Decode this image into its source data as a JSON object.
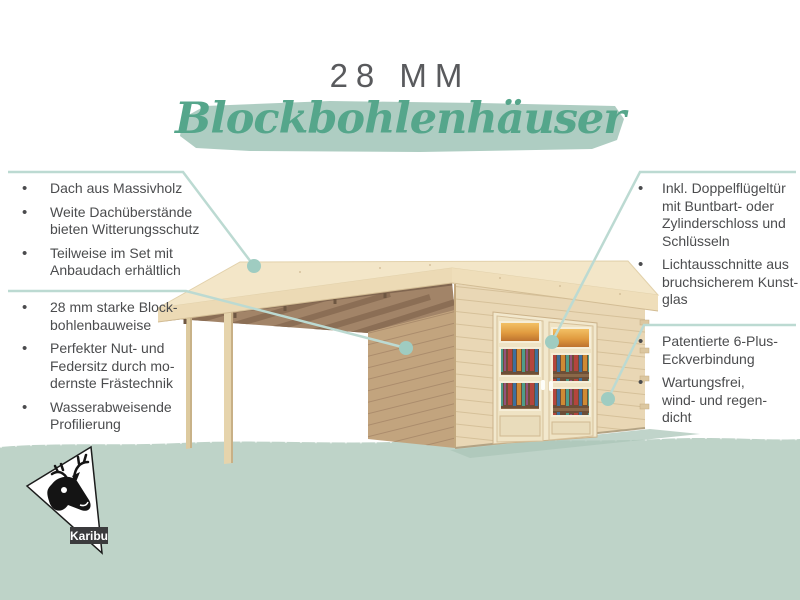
{
  "title": {
    "size": "28 MM",
    "script": "Blockbohlenhäuser"
  },
  "bullet_glyph": "•",
  "features": {
    "left_top": {
      "items": [
        "Dach aus Massivholz",
        "Weite Dachüberstände\nbieten Witterungsschutz",
        "Teilweise im Set mit\nAnbaudach erhältlich"
      ]
    },
    "left_bottom": {
      "items": [
        "28 mm starke Block-\nbohlenbauweise",
        "Perfekter Nut- und\nFedersitz durch mo-\ndernste Frästechnik",
        "Wasserabweisende\nProfilierung"
      ]
    },
    "right_top": {
      "items": [
        "Inkl. Doppelflügeltür\nmit Buntbart- oder\nZylinderschloss und\nSchlüsseln",
        "Lichtausschnitte aus\nbruchsicherem Kunst-\nglas"
      ]
    },
    "right_bottom": {
      "items": [
        "Patentierte 6-Plus-\nEckverbindung",
        "Wartungsfrei,\nwind- und regen-\ndicht"
      ]
    }
  },
  "logo": {
    "brand": "Karibu"
  },
  "colors": {
    "title_gray": "#595a5d",
    "text_gray": "#4b4c4e",
    "script_green": "#55a68b",
    "brush_green": "#aecdc2",
    "ground_green": "#bed3c8",
    "callout_line": "#bcdad2",
    "callout_dot": "#9fccc1",
    "wood_light": "#e9d7b5",
    "wood_roof": "#f3e6c8",
    "wood_shaded": "#c2a47e",
    "wood_beams": "#a28468"
  }
}
